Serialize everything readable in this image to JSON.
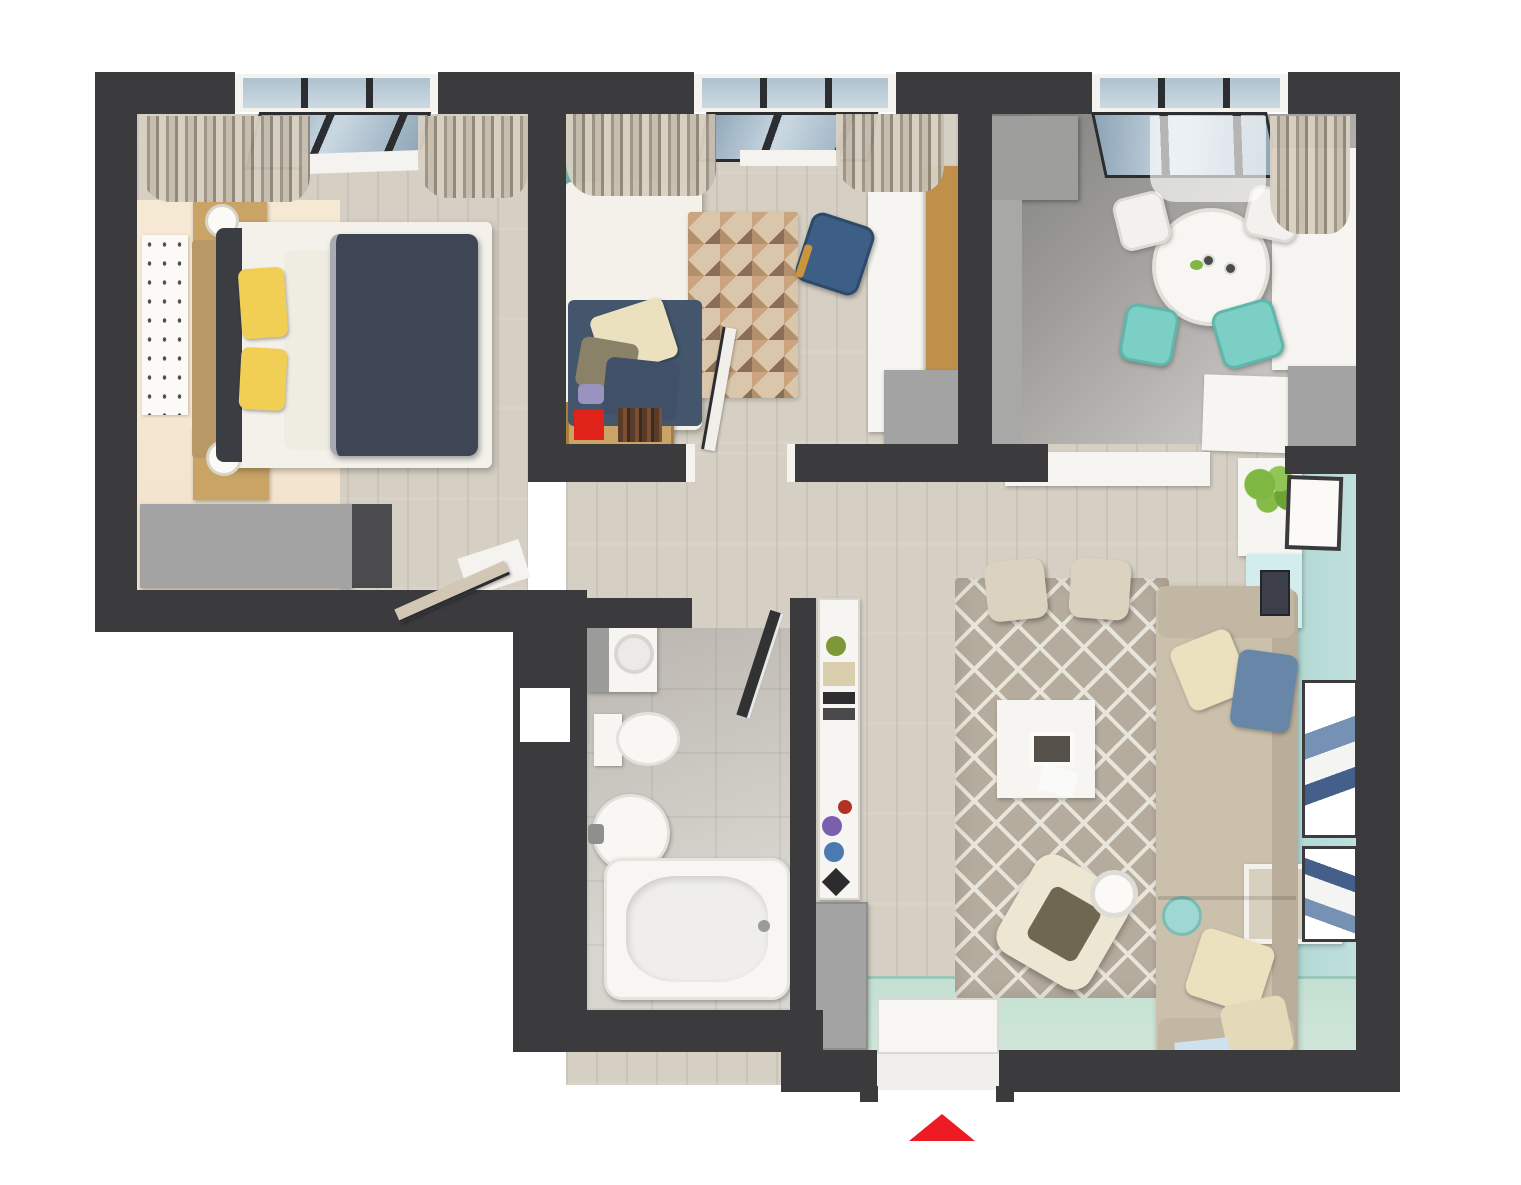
{
  "colors": {
    "bg": "#ffffff",
    "wall": "#3b3b3d",
    "wood": "#d6d0c4",
    "peach": "#f2e3cd",
    "teal-accent": "#74aba4",
    "bath-floor": "#d2cec7",
    "mint": "#cfe6d9",
    "teal-floor": "#bfe0dd",
    "white-furn": "#f6f5f1",
    "gray-furn": "#a3a3a3",
    "gray-dark": "#4b4b4d",
    "navy": "#3e4554",
    "navy2": "#44566c",
    "yellow": "#f1cf55",
    "cream": "#ece1bf",
    "sofa": "#cbc0ac",
    "sofa-dark": "#b9ae9a",
    "rug": "#b6ac9e",
    "rug-line": "#e9e5da",
    "rug2-a": "#b3906d",
    "rug2-b": "#8a6f55",
    "rug2-c": "#d9c6ab",
    "wood-furn": "#c9a466",
    "wood-door": "#d2c7b4",
    "teal-chair": "#7bcfc5",
    "blue-chair": "#3d5f86",
    "blue-pillow": "#6786a8",
    "red": "#e02318",
    "arrow": "#ed1c24",
    "glass-a": "#8da4b5",
    "glass-b": "#c9d8e2",
    "curtain-a": "#d8d0c2",
    "curtain-b": "#9d9384",
    "plant": "#7fb743",
    "olive": "#6f6752",
    "dark": "#2c2c2e"
  },
  "rooms": [
    {
      "name": "bedroom"
    },
    {
      "name": "kids-bedroom"
    },
    {
      "name": "kitchen-dining"
    },
    {
      "name": "living-room"
    },
    {
      "name": "hallway"
    },
    {
      "name": "bathroom"
    },
    {
      "name": "entrance"
    }
  ],
  "marker": {
    "name": "entrance-direction-arrow",
    "shape": "triangle-up",
    "color": "#ed1c24"
  }
}
